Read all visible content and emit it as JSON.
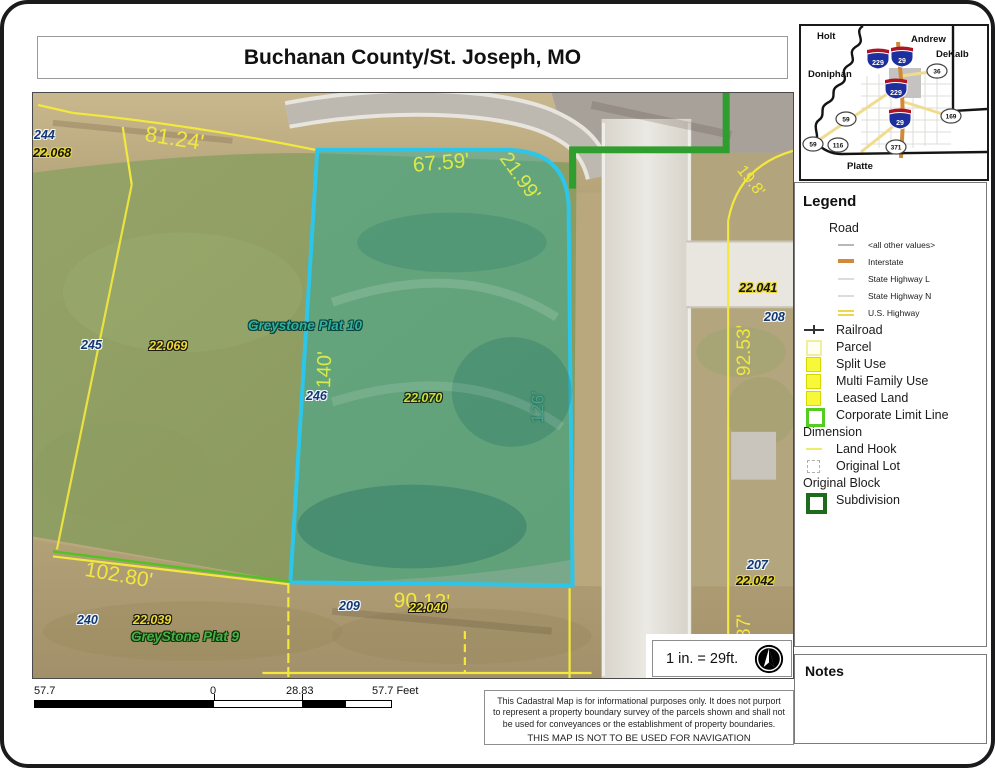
{
  "title": "Buchanan County/St. Joseph, MO",
  "colors": {
    "parcel_highlight": "#2cc6ea",
    "parcel_line": "#f3e93c",
    "corporate_limit": "#2f9e2f",
    "subdivision_green": "#1e6b1e",
    "interstate_orange": "#d08a3a",
    "dimension_yellow": "#f1e73d"
  },
  "map": {
    "labels": [
      {
        "t": "244",
        "c": "navy",
        "x": 1,
        "y": 36
      },
      {
        "t": "22.068",
        "c": "black-yellow",
        "x": 0,
        "y": 54
      },
      {
        "t": "81.24'",
        "c": "dim-y s22",
        "x": 114,
        "y": 30,
        "r": 9
      },
      {
        "t": "67.59'",
        "c": "dim-g s21",
        "x": 379,
        "y": 62,
        "r": -5
      },
      {
        "t": "21.99'",
        "c": "dim-g s20",
        "x": 479,
        "y": 56,
        "r": 54
      },
      {
        "t": "19.8'",
        "c": "dim-y s16",
        "x": 713,
        "y": 70,
        "r": 52
      },
      {
        "t": "Greystone Plat 10",
        "c": "plat-teal",
        "x": 215,
        "y": 226
      },
      {
        "t": "140'",
        "c": "dim-g s20",
        "x": 281,
        "y": 295,
        "r": -88
      },
      {
        "t": "126'",
        "c": "dim-t s17",
        "x": 496,
        "y": 330,
        "r": -89
      },
      {
        "t": "245",
        "c": "navy",
        "x": 48,
        "y": 246
      },
      {
        "t": "22.069",
        "c": "yellow-black",
        "x": 116,
        "y": 247
      },
      {
        "t": "246",
        "c": "navy",
        "x": 273,
        "y": 297
      },
      {
        "t": "22.070",
        "c": "green-black",
        "x": 371,
        "y": 299
      },
      {
        "t": "22.041",
        "c": "black-yellow",
        "x": 706,
        "y": 189
      },
      {
        "t": "208",
        "c": "navy",
        "x": 731,
        "y": 218
      },
      {
        "t": "92.53'",
        "c": "dim-y s19",
        "x": 702,
        "y": 283,
        "r": -90
      },
      {
        "t": "207",
        "c": "navy",
        "x": 714,
        "y": 466
      },
      {
        "t": "22.042",
        "c": "black-yellow",
        "x": 703,
        "y": 482
      },
      {
        "t": "87'",
        "c": "dim-y s19",
        "x": 702,
        "y": 546,
        "r": -90
      },
      {
        "t": "102.80'",
        "c": "dim-y s21",
        "x": 54,
        "y": 466,
        "r": 10
      },
      {
        "t": "240",
        "c": "navy",
        "x": 44,
        "y": 521
      },
      {
        "t": "22.039",
        "c": "yellow-black",
        "x": 100,
        "y": 521
      },
      {
        "t": "GreyStone Plat 9",
        "c": "plat-green",
        "x": 98,
        "y": 537
      },
      {
        "t": "90.12'",
        "c": "dim-y s21",
        "x": 361,
        "y": 497,
        "r": 2
      },
      {
        "t": "209",
        "c": "navy",
        "x": 306,
        "y": 507
      },
      {
        "t": "22.040",
        "c": "yellow-black",
        "x": 376,
        "y": 509
      }
    ]
  },
  "inset": {
    "counties": [
      "Holt",
      "Andrew",
      "DeKalb",
      "Doniphan",
      "Platte"
    ],
    "interstate_shields": [
      "229",
      "29",
      "229",
      "29"
    ],
    "us_shields": [
      "36",
      "169",
      "59",
      "59",
      "116",
      "371"
    ]
  },
  "legend": {
    "title": "Legend",
    "items": [
      {
        "label": "Road",
        "sym": "none",
        "cls": "group"
      },
      {
        "label": "<all other values>",
        "sym": "line-gray",
        "cls": "sub"
      },
      {
        "label": "Interstate",
        "sym": "line-interstate",
        "cls": "sub"
      },
      {
        "label": "State Highway L",
        "sym": "line-state",
        "cls": "sub"
      },
      {
        "label": "State Highway N",
        "sym": "line-state",
        "cls": "sub"
      },
      {
        "label": "U.S. Highway",
        "sym": "line-us",
        "cls": "sub"
      },
      {
        "label": "Railroad",
        "sym": "railroad",
        "cls": "main"
      },
      {
        "label": "Parcel",
        "sym": "parcel",
        "cls": "main"
      },
      {
        "label": "Split Use",
        "sym": "split-use",
        "cls": "main"
      },
      {
        "label": "Multi Family Use",
        "sym": "multi-family",
        "cls": "main"
      },
      {
        "label": "Leased Land",
        "sym": "leased-land",
        "cls": "main"
      },
      {
        "label": "Corporate Limit Line",
        "sym": "corporate-limit",
        "cls": "main"
      },
      {
        "label": "Dimension",
        "sym": "none",
        "cls": "main"
      },
      {
        "label": "Land Hook",
        "sym": "land-hook",
        "cls": "main"
      },
      {
        "label": "Original Lot",
        "sym": "original-lot",
        "cls": "main"
      },
      {
        "label": "Original Block",
        "sym": "none",
        "cls": "main"
      },
      {
        "label": "Subdivision",
        "sym": "subdivision",
        "cls": "main"
      }
    ]
  },
  "scale_note": "1 in. = 29ft.",
  "scalebar": {
    "left": "57.7",
    "zero": "0",
    "mid": "28.83",
    "right": "57.7 Feet"
  },
  "notes_title": "Notes",
  "disclaimer": {
    "body": "This Cadastral Map is for informational purposes only.  It does not purport to represent a property boundary survey of the parcels shown and shall not be used for conveyances or the establishment of property boundaries.",
    "nav": "THIS MAP IS NOT TO BE USED FOR NAVIGATION"
  }
}
